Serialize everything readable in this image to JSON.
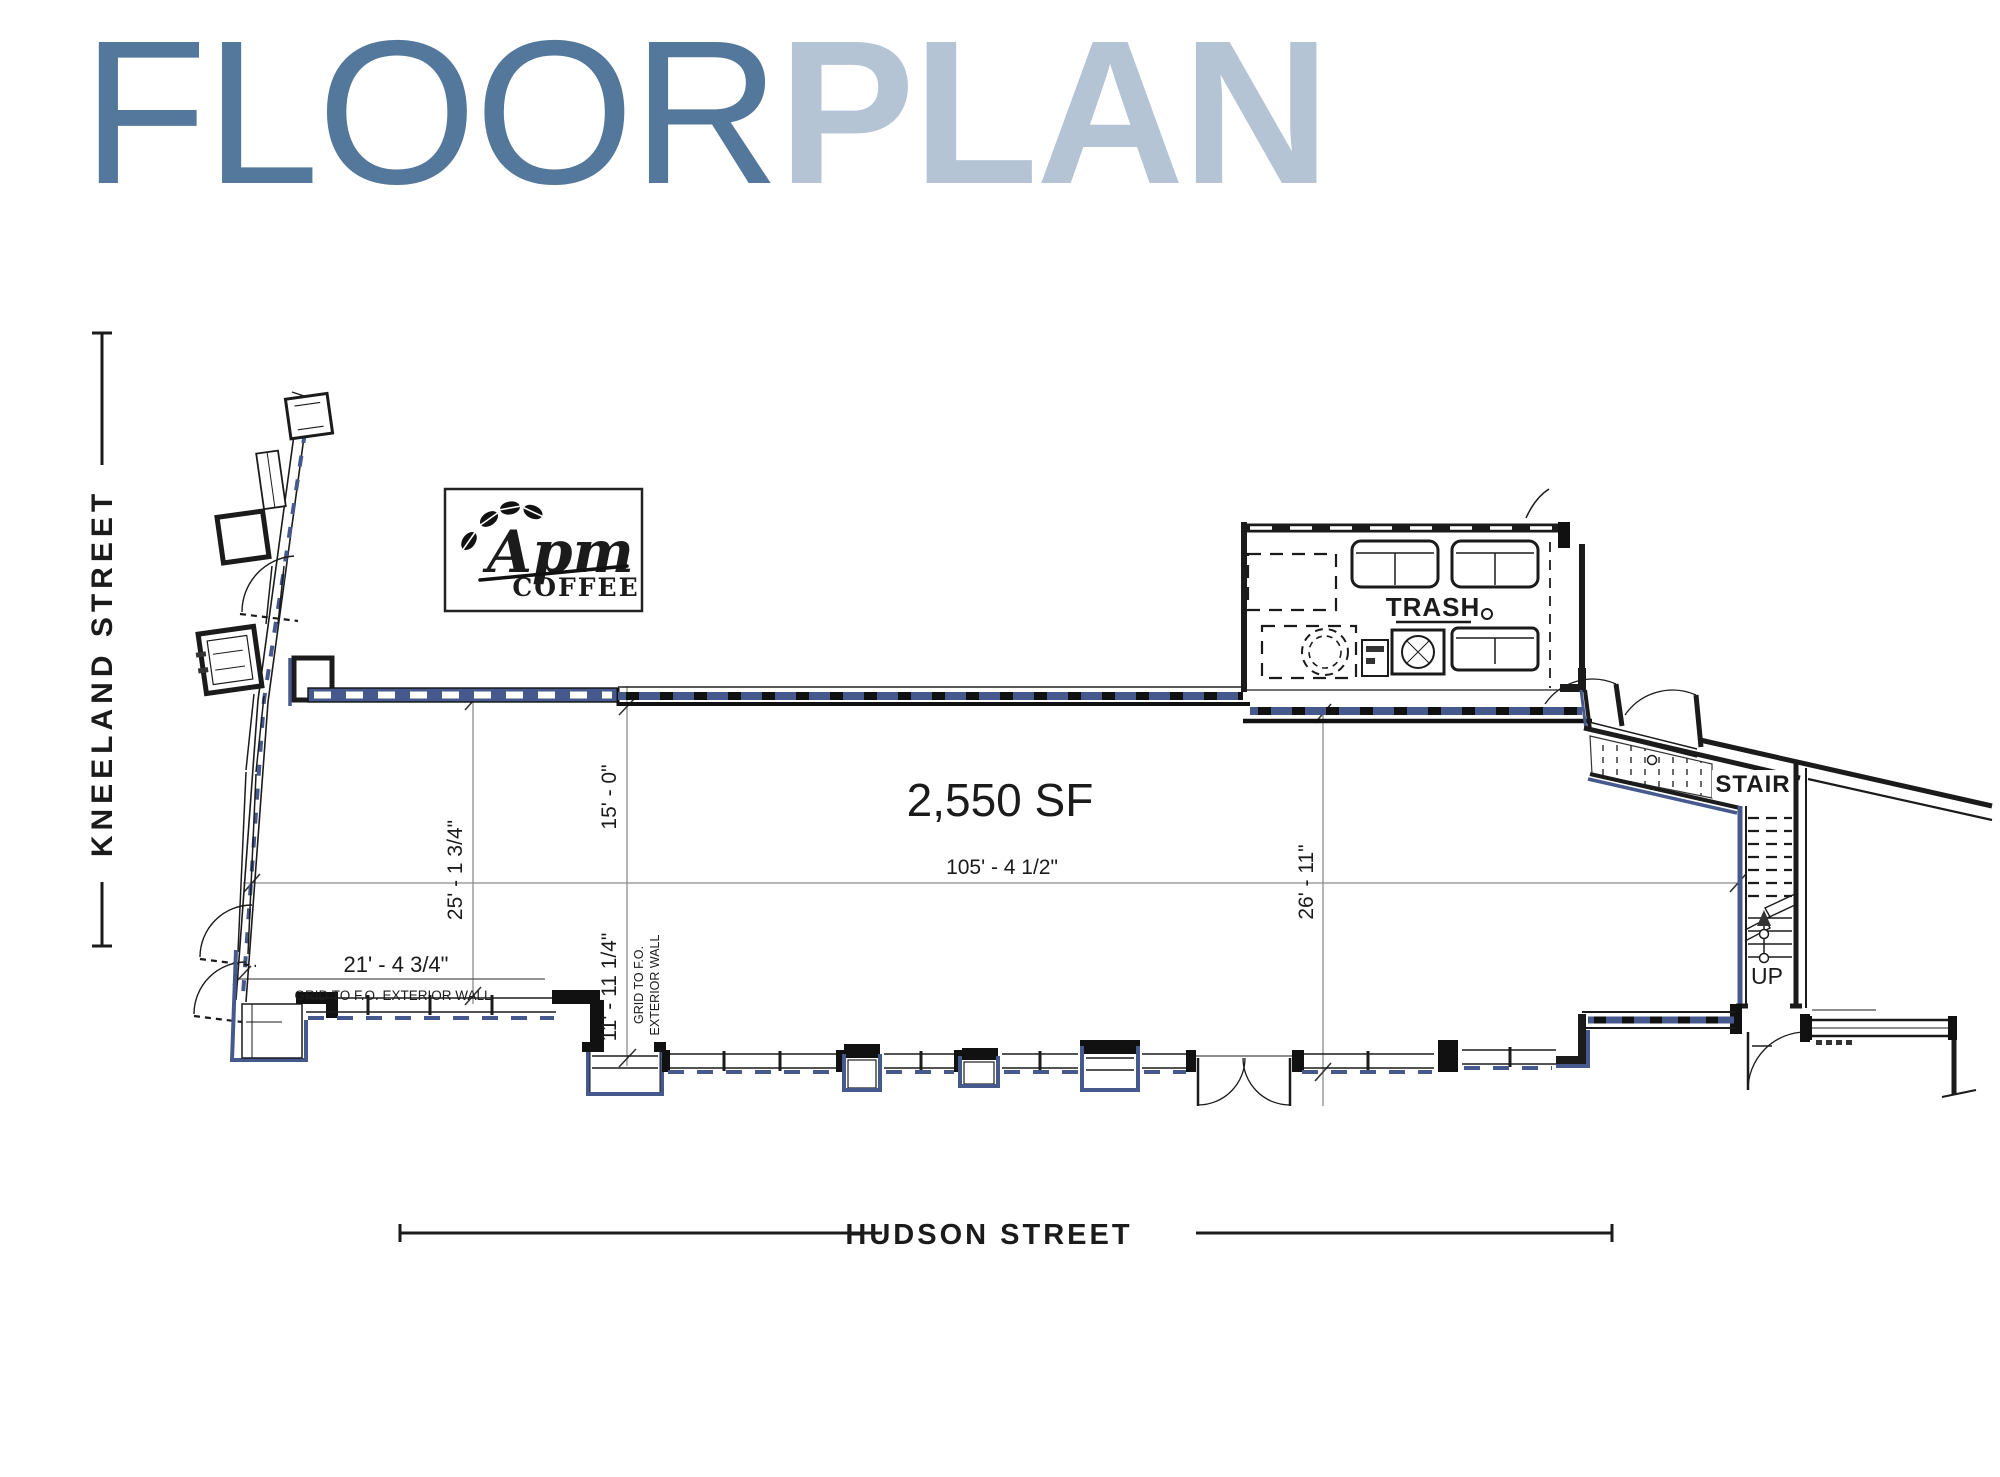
{
  "title": {
    "floor": "FLOOR",
    "plan": "PLAN"
  },
  "colors": {
    "floor_title": "#54789b",
    "plan_title": "#b5c4d5",
    "wall_blue": "#46598c",
    "line_dark": "#1b1b1b",
    "line_gray": "#8c8c8c"
  },
  "streets": {
    "left": "KNEELAND STREET",
    "bottom": "HUDSON STREET"
  },
  "logo": {
    "name": "Apm",
    "word": "COFFEE"
  },
  "plan": {
    "area_label": "2,550 SF",
    "rooms": {
      "trash": "TRASH",
      "stair": "STAIR",
      "up": "UP"
    },
    "dimensions": {
      "d25": "25' - 1 3/4\"",
      "d15": "15' - 0\"",
      "d105": "105' - 4 1/2\"",
      "d26": "26' - 11\"",
      "d21": "21' - 4 3/4\"",
      "d11": "11' - 11 1/4\"",
      "grid_note": "GRID TO F.O. EXTERIOR WALL",
      "grid_note_line1": "GRID TO F.O.",
      "grid_note_line2": "EXTERIOR WALL"
    }
  }
}
